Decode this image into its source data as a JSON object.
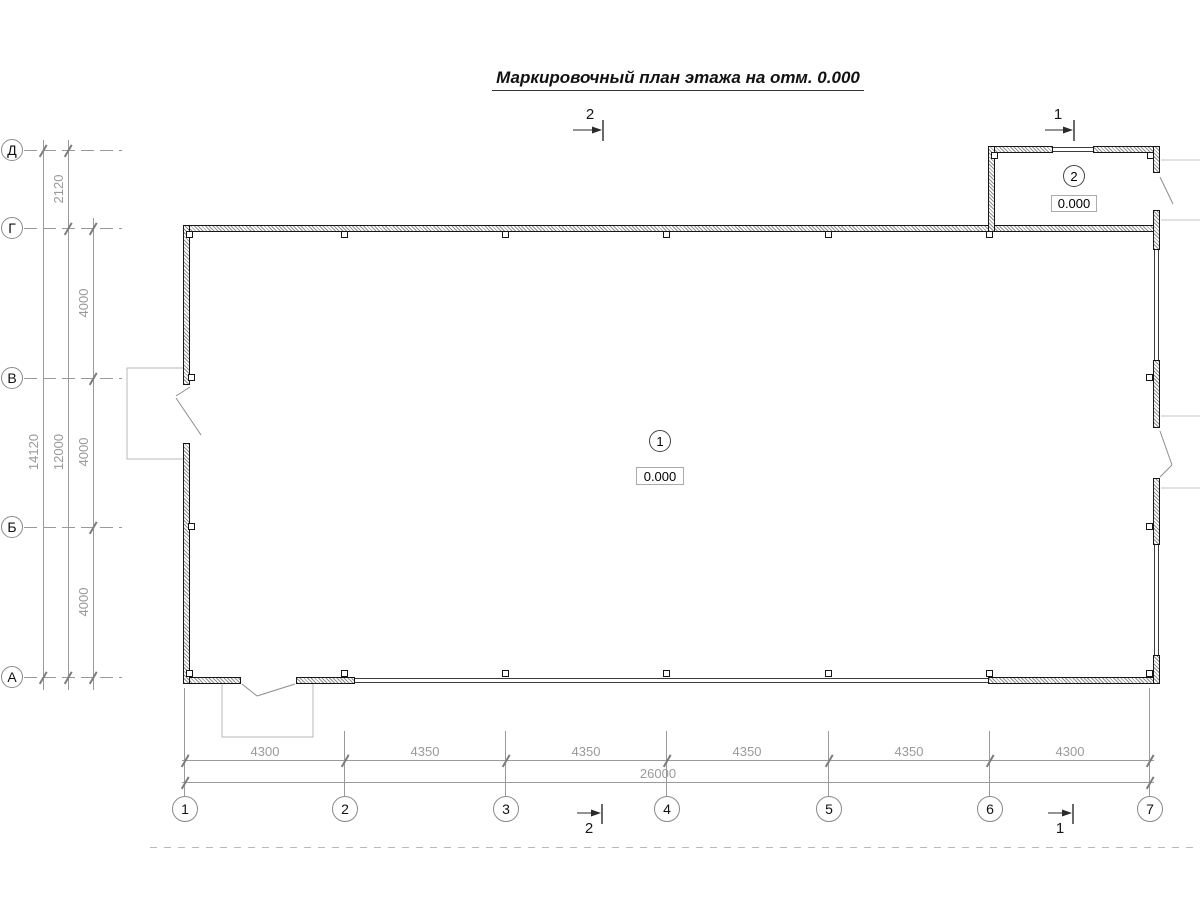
{
  "title": "Маркировочный план этажа на отм. 0.000",
  "axes": {
    "vertical": [
      {
        "label": "Д"
      },
      {
        "label": "Г"
      },
      {
        "label": "В"
      },
      {
        "label": "Б"
      },
      {
        "label": "А"
      }
    ],
    "horizontal": [
      {
        "label": "1"
      },
      {
        "label": "2"
      },
      {
        "label": "3"
      },
      {
        "label": "4"
      },
      {
        "label": "5"
      },
      {
        "label": "6"
      },
      {
        "label": "7"
      }
    ]
  },
  "dimensions": {
    "left": {
      "overall": "14120",
      "subtotal": "12000",
      "top_bay": "2120",
      "bays": [
        "4000",
        "4000",
        "4000"
      ]
    },
    "bottom": {
      "bays": [
        "4300",
        "4350",
        "4350",
        "4350",
        "4350",
        "4300"
      ],
      "overall": "26000"
    }
  },
  "rooms": [
    {
      "number": "1",
      "elevation": "0.000"
    },
    {
      "number": "2",
      "elevation": "0.000"
    }
  ],
  "section_markers": {
    "top": [
      "2",
      "1"
    ],
    "bottom": [
      "2",
      "1"
    ]
  }
}
